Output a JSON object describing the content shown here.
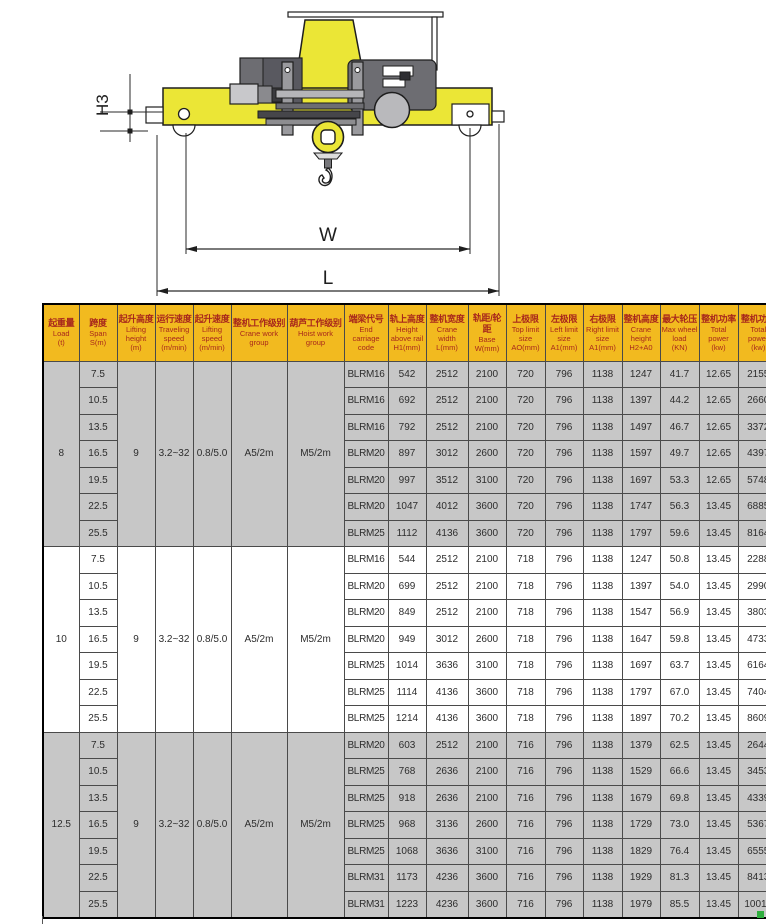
{
  "diagram": {
    "labels": {
      "h3": "H3",
      "w": "W",
      "l": "L"
    },
    "colors": {
      "crane_yellow": "#ebe636",
      "machinery_gray": "#6d6d72",
      "light_gray": "#c8c8cb",
      "outline": "#1e1e1e"
    }
  },
  "table": {
    "header_bg": "#f2ba1f",
    "header_text_color": "#a8281c",
    "shaded_row_bg": "#c7c7c7",
    "columns": [
      {
        "cn": "起重量",
        "en": "Load",
        "sub": "(t)"
      },
      {
        "cn": "跨度",
        "en": "Span",
        "sub": "S(m)"
      },
      {
        "cn": "起升高度",
        "en": "Lifting height",
        "sub": "(m)"
      },
      {
        "cn": "运行速度",
        "en": "Traveling speed",
        "sub": "(m/min)"
      },
      {
        "cn": "起升速度",
        "en": "Lifting speed",
        "sub": "(m/min)"
      },
      {
        "cn": "整机工作级别",
        "en": "Crane work group",
        "sub": ""
      },
      {
        "cn": "葫芦工作级别",
        "en": "Hoist work group",
        "sub": ""
      },
      {
        "cn": "端梁代号",
        "en": "End carriage code",
        "sub": ""
      },
      {
        "cn": "轨上高度",
        "en": "Height above rail",
        "sub": "H1(mm)"
      },
      {
        "cn": "整机宽度",
        "en": "Crane width",
        "sub": "L(mm)"
      },
      {
        "cn": "轨距/轮距",
        "en": "Base",
        "sub": "W(mm)"
      },
      {
        "cn": "上极限",
        "en": "Top limit size",
        "sub": "AO(mm)"
      },
      {
        "cn": "左极限",
        "en": "Left limit size",
        "sub": "A1(mm)"
      },
      {
        "cn": "右极限",
        "en": "Right limit size",
        "sub": "A1(mm)"
      },
      {
        "cn": "整机高度",
        "en": "Crane height",
        "sub": "H2+A0"
      },
      {
        "cn": "最大轮压",
        "en": "Max wheel load",
        "sub": "(KN)"
      },
      {
        "cn": "整机功率",
        "en": "Total power",
        "sub": "(kw)"
      },
      {
        "cn": "整机功率",
        "en": "Total power",
        "sub": "(kw)"
      }
    ],
    "groups": [
      {
        "load": "8",
        "lifting_height": "9",
        "traveling_speed": "3.2~32",
        "lifting_speed": "0.8/5.0",
        "crane_work_group": "A5/2m",
        "hoist_work_group": "M5/2m",
        "shaded": true,
        "rows": [
          [
            "7.5",
            "BLRM16",
            "542",
            "2512",
            "2100",
            "720",
            "796",
            "1138",
            "1247",
            "41.7",
            "12.65",
            "2155"
          ],
          [
            "10.5",
            "BLRM16",
            "692",
            "2512",
            "2100",
            "720",
            "796",
            "1138",
            "1397",
            "44.2",
            "12.65",
            "2660"
          ],
          [
            "13.5",
            "BLRM16",
            "792",
            "2512",
            "2100",
            "720",
            "796",
            "1138",
            "1497",
            "46.7",
            "12.65",
            "3372"
          ],
          [
            "16.5",
            "BLRM20",
            "897",
            "3012",
            "2600",
            "720",
            "796",
            "1138",
            "1597",
            "49.7",
            "12.65",
            "4397"
          ],
          [
            "19.5",
            "BLRM20",
            "997",
            "3512",
            "3100",
            "720",
            "796",
            "1138",
            "1697",
            "53.3",
            "12.65",
            "5748"
          ],
          [
            "22.5",
            "BLRM20",
            "1047",
            "4012",
            "3600",
            "720",
            "796",
            "1138",
            "1747",
            "56.3",
            "13.45",
            "6885"
          ],
          [
            "25.5",
            "BLRM25",
            "1112",
            "4136",
            "3600",
            "720",
            "796",
            "1138",
            "1797",
            "59.6",
            "13.45",
            "8164"
          ]
        ]
      },
      {
        "load": "10",
        "lifting_height": "9",
        "traveling_speed": "3.2~32",
        "lifting_speed": "0.8/5.0",
        "crane_work_group": "A5/2m",
        "hoist_work_group": "M5/2m",
        "shaded": false,
        "rows": [
          [
            "7.5",
            "BLRM16",
            "544",
            "2512",
            "2100",
            "718",
            "796",
            "1138",
            "1247",
            "50.8",
            "13.45",
            "2288"
          ],
          [
            "10.5",
            "BLRM20",
            "699",
            "2512",
            "2100",
            "718",
            "796",
            "1138",
            "1397",
            "54.0",
            "13.45",
            "2990"
          ],
          [
            "13.5",
            "BLRM20",
            "849",
            "2512",
            "2100",
            "718",
            "796",
            "1138",
            "1547",
            "56.9",
            "13.45",
            "3803"
          ],
          [
            "16.5",
            "BLRM20",
            "949",
            "3012",
            "2600",
            "718",
            "796",
            "1138",
            "1647",
            "59.8",
            "13.45",
            "4733"
          ],
          [
            "19.5",
            "BLRM25",
            "1014",
            "3636",
            "3100",
            "718",
            "796",
            "1138",
            "1697",
            "63.7",
            "13.45",
            "6164"
          ],
          [
            "22.5",
            "BLRM25",
            "1114",
            "4136",
            "3600",
            "718",
            "796",
            "1138",
            "1797",
            "67.0",
            "13.45",
            "7404"
          ],
          [
            "25.5",
            "BLRM25",
            "1214",
            "4136",
            "3600",
            "718",
            "796",
            "1138",
            "1897",
            "70.2",
            "13.45",
            "8609"
          ]
        ]
      },
      {
        "load": "12.5",
        "lifting_height": "9",
        "traveling_speed": "3.2~32",
        "lifting_speed": "0.8/5.0",
        "crane_work_group": "A5/2m",
        "hoist_work_group": "M5/2m",
        "shaded": true,
        "rows": [
          [
            "7.5",
            "BLRM20",
            "603",
            "2512",
            "2100",
            "716",
            "796",
            "1138",
            "1379",
            "62.5",
            "13.45",
            "2644"
          ],
          [
            "10.5",
            "BLRM25",
            "768",
            "2636",
            "2100",
            "716",
            "796",
            "1138",
            "1529",
            "66.6",
            "13.45",
            "3453"
          ],
          [
            "13.5",
            "BLRM25",
            "918",
            "2636",
            "2100",
            "716",
            "796",
            "1138",
            "1679",
            "69.8",
            "13.45",
            "4339"
          ],
          [
            "16.5",
            "BLRM25",
            "968",
            "3136",
            "2600",
            "716",
            "796",
            "1138",
            "1729",
            "73.0",
            "13.45",
            "5367"
          ],
          [
            "19.5",
            "BLRM25",
            "1068",
            "3636",
            "3100",
            "716",
            "796",
            "1138",
            "1829",
            "76.4",
            "13.45",
            "6555"
          ],
          [
            "22.5",
            "BLRM31",
            "1173",
            "4236",
            "3600",
            "716",
            "796",
            "1138",
            "1929",
            "81.3",
            "13.45",
            "8413"
          ],
          [
            "25.5",
            "BLRM31",
            "1223",
            "4236",
            "3600",
            "716",
            "796",
            "1138",
            "1979",
            "85.5",
            "13.45",
            "10019"
          ]
        ]
      }
    ]
  }
}
